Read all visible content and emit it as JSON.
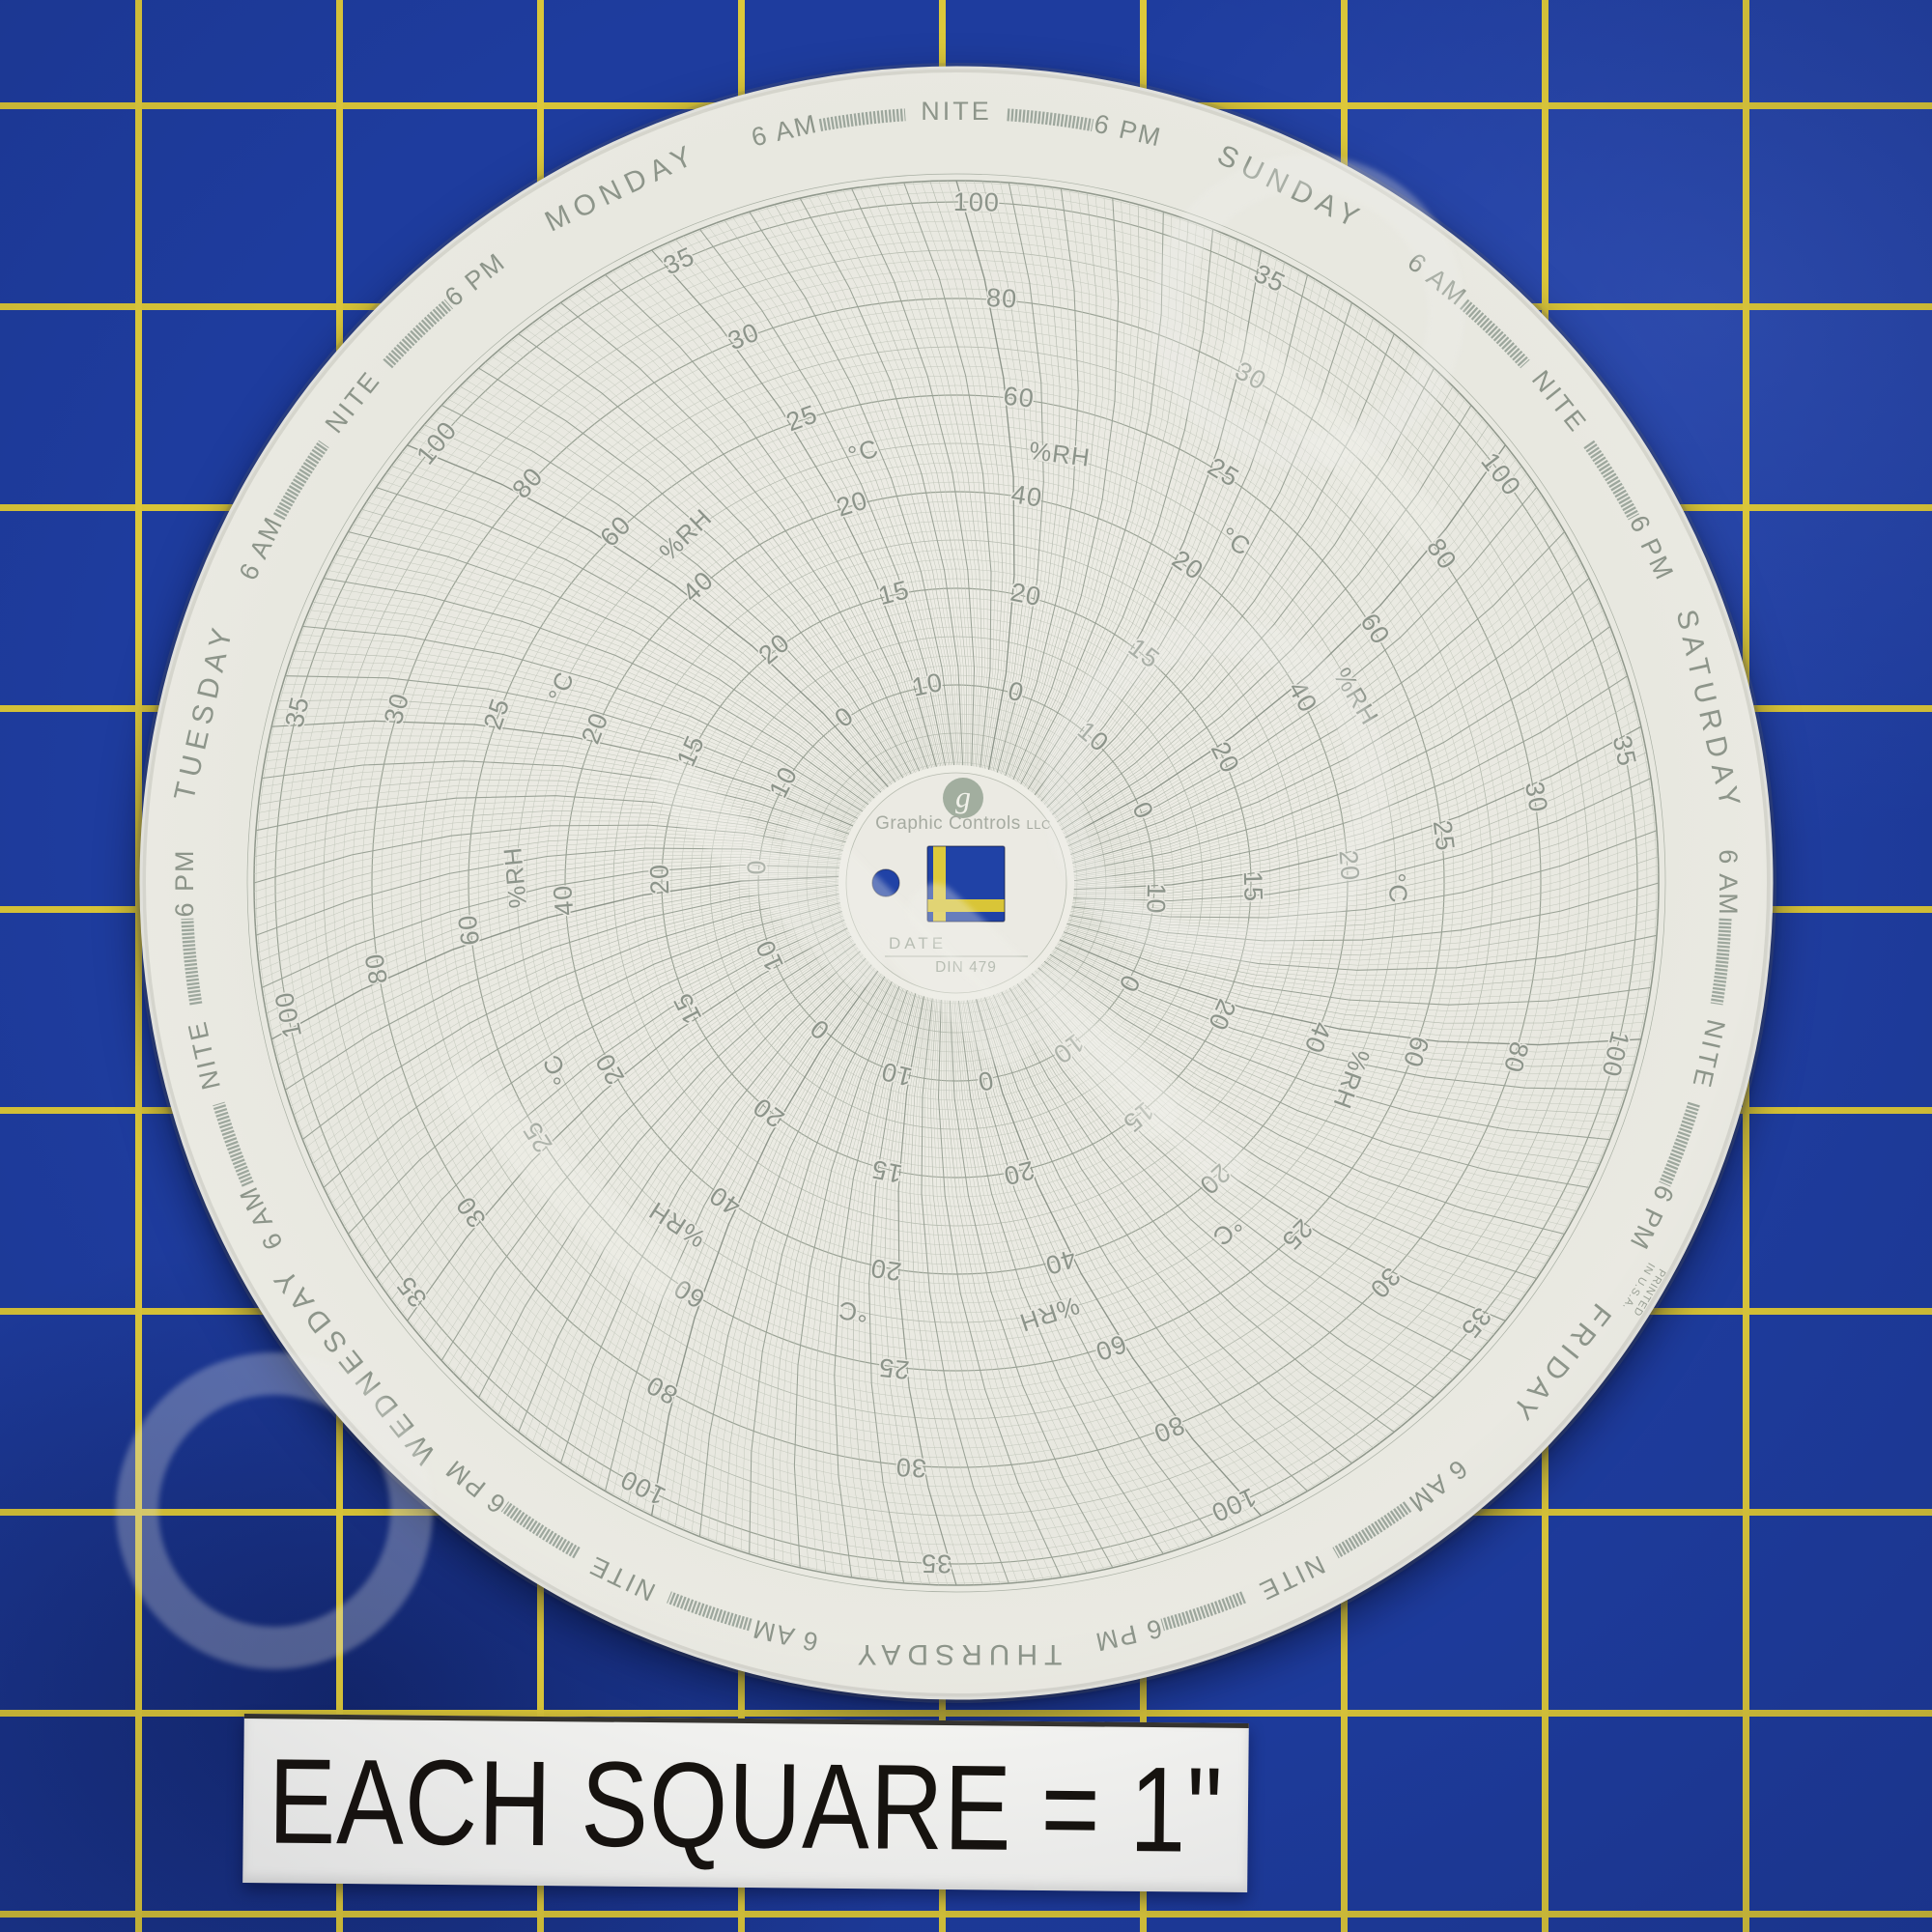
{
  "chart": {
    "brand": "Graphic Controls",
    "brand_suffix": "LLC",
    "logo_letter": "g",
    "date_label": "DATE",
    "model": "DIN 479",
    "printed_note_lines": [
      "PRINTED",
      "IN U.S.A."
    ],
    "days_clockwise_from_top": [
      "SUNDAY",
      "SATURDAY",
      "FRIDAY",
      "THURSDAY",
      "WEDNESDAY",
      "TUESDAY",
      "MONDAY"
    ],
    "time_labels": {
      "morning": "6 AM",
      "night": "NITE",
      "evening": "6 PM"
    },
    "scales": {
      "temperature": {
        "unit": "°C",
        "values": [
          10,
          15,
          20,
          25,
          30,
          35
        ]
      },
      "humidity": {
        "unit": "%RH",
        "values": [
          0,
          20,
          40,
          60,
          80,
          100
        ]
      }
    }
  },
  "ruler_label": {
    "text": "EACH SQUARE = 1\""
  },
  "watermark": {
    "legible": false
  },
  "colors": {
    "mat_blue": "#1e3c9e",
    "mat_grid_yellow": "#dcc83a",
    "paper": "#eae9e2",
    "ink_green_gray": "#8d958a",
    "label_black": "#17130e"
  }
}
